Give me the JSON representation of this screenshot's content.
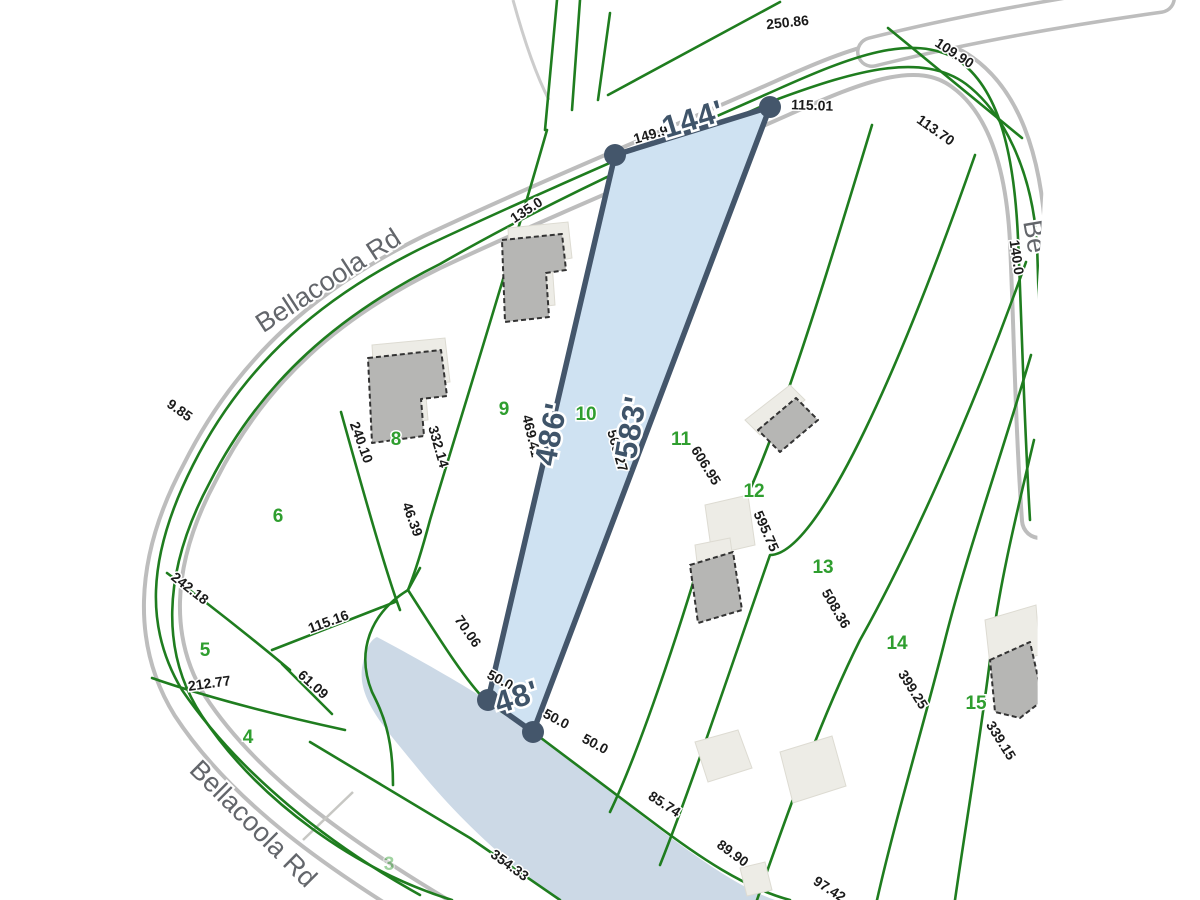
{
  "map": {
    "type": "parcel-plat-map",
    "selected_parcel": {
      "lot_number": "10",
      "frontage_label": "144'",
      "west_side_label": "486'",
      "east_side_label": "583'",
      "rear_label": "48'"
    },
    "colors": {
      "parcel_fill": "#cfe2f2",
      "parcel_border": "#44566b",
      "line_green": "#1f7d1f",
      "water": "#ccd9e6",
      "label_dark": "#1a1a1a",
      "big_dim": "#3f5469",
      "lot_green": "#2f9e2f",
      "road_casing": "#bdbdbd",
      "road_label": "#63666b",
      "bldg_dark": "#b6b6b4",
      "bldg_light": "#edece6"
    },
    "road_labels": [
      {
        "t": "Bellacoola Rd",
        "x": 333,
        "y": 288,
        "r": -33
      },
      {
        "t": "Bellacoola Rd",
        "x": 247,
        "y": 830,
        "r": 45
      },
      {
        "t": "Be",
        "x": 1026,
        "y": 238,
        "r": 80
      }
    ],
    "big_dimensions": [
      {
        "t": "144'",
        "x": 696,
        "y": 129,
        "r": -17
      },
      {
        "t": "486'",
        "x": 561,
        "y": 436,
        "r": -79
      },
      {
        "t": "583'",
        "x": 641,
        "y": 429,
        "r": -80
      },
      {
        "t": "48'",
        "x": 520,
        "y": 707,
        "r": -18
      }
    ],
    "small_dimensions": [
      {
        "t": "250.86",
        "x": 788,
        "y": 27,
        "r": -6
      },
      {
        "t": "109.90",
        "x": 952,
        "y": 57,
        "r": 33
      },
      {
        "t": "115.01",
        "x": 812,
        "y": 110,
        "r": 2
      },
      {
        "t": "113.70",
        "x": 933,
        "y": 134,
        "r": 35
      },
      {
        "t": "135.0",
        "x": 529,
        "y": 214,
        "r": -33
      },
      {
        "t": "140.0",
        "x": 1012,
        "y": 258,
        "r": 82
      },
      {
        "t": "149.9",
        "x": 652,
        "y": 139,
        "r": -16
      },
      {
        "t": "240.10",
        "x": 357,
        "y": 444,
        "r": 70
      },
      {
        "t": "332.14",
        "x": 434,
        "y": 448,
        "r": 74
      },
      {
        "t": "469.41",
        "x": 527,
        "y": 437,
        "r": 77
      },
      {
        "t": "569.27",
        "x": 613,
        "y": 452,
        "r": 74
      },
      {
        "t": "606.95",
        "x": 702,
        "y": 468,
        "r": 58
      },
      {
        "t": "595.75",
        "x": 762,
        "y": 533,
        "r": 66
      },
      {
        "t": "508.36",
        "x": 832,
        "y": 611,
        "r": 60
      },
      {
        "t": "399.25",
        "x": 909,
        "y": 692,
        "r": 58
      },
      {
        "t": "339.15",
        "x": 997,
        "y": 743,
        "r": 58
      },
      {
        "t": "46.39",
        "x": 408,
        "y": 521,
        "r": 70
      },
      {
        "t": "70.06",
        "x": 464,
        "y": 634,
        "r": 55
      },
      {
        "t": "9.85",
        "x": 177,
        "y": 414,
        "r": 35
      },
      {
        "t": "242.18",
        "x": 187,
        "y": 592,
        "r": 38
      },
      {
        "t": "115.16",
        "x": 330,
        "y": 626,
        "r": -20
      },
      {
        "t": "212.77",
        "x": 210,
        "y": 688,
        "r": -8
      },
      {
        "t": "61.09",
        "x": 310,
        "y": 688,
        "r": 42
      },
      {
        "t": "50.0",
        "x": 498,
        "y": 684,
        "r": 28
      },
      {
        "t": "50.0",
        "x": 554,
        "y": 723,
        "r": 28
      },
      {
        "t": "50.0",
        "x": 593,
        "y": 748,
        "r": 28
      },
      {
        "t": "85.74",
        "x": 662,
        "y": 808,
        "r": 33
      },
      {
        "t": "89.90",
        "x": 730,
        "y": 857,
        "r": 36
      },
      {
        "t": "97.42",
        "x": 827,
        "y": 893,
        "r": 33
      },
      {
        "t": "354.33",
        "x": 507,
        "y": 869,
        "r": 36
      }
    ],
    "lot_numbers": [
      {
        "t": "3",
        "x": 389,
        "y": 870,
        "o": 0.45
      },
      {
        "t": "4",
        "x": 248,
        "y": 743
      },
      {
        "t": "5",
        "x": 205,
        "y": 656
      },
      {
        "t": "6",
        "x": 278,
        "y": 522
      },
      {
        "t": "8",
        "x": 396,
        "y": 445
      },
      {
        "t": "9",
        "x": 504,
        "y": 415
      },
      {
        "t": "10",
        "x": 586,
        "y": 420
      },
      {
        "t": "11",
        "x": 681,
        "y": 445
      },
      {
        "t": "12",
        "x": 754,
        "y": 497
      },
      {
        "t": "13",
        "x": 823,
        "y": 573
      },
      {
        "t": "14",
        "x": 897,
        "y": 649
      },
      {
        "t": "15",
        "x": 976,
        "y": 709
      }
    ]
  }
}
